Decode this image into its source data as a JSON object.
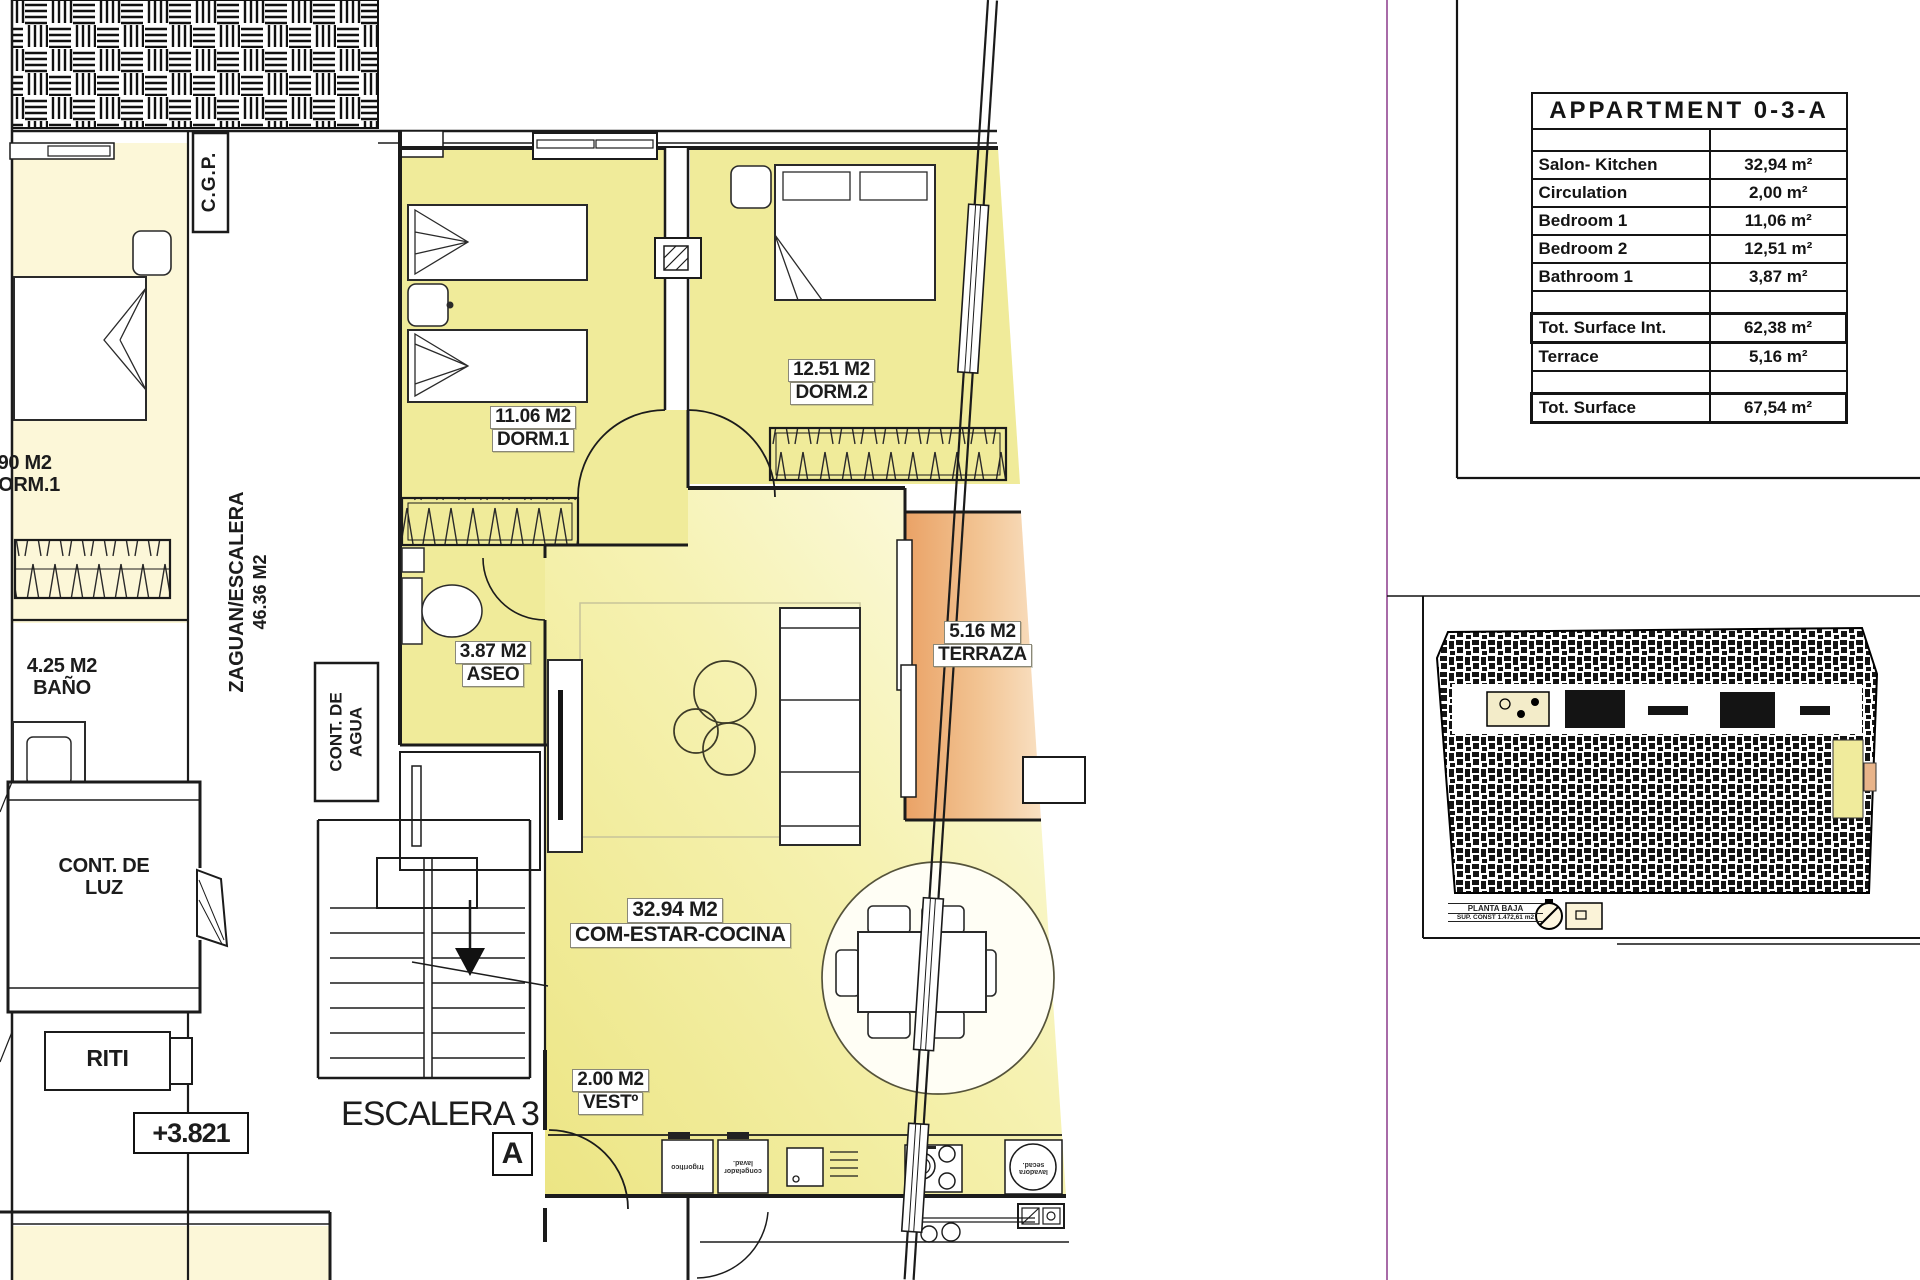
{
  "sheet": {
    "table": {
      "title": "APPARTMENT 0-3-A",
      "rows": [
        {
          "label": "Salon- Kitchen",
          "value": "32,94 m²"
        },
        {
          "label": "Circulation",
          "value": "2,00 m²"
        },
        {
          "label": "Bedroom 1",
          "value": "11,06 m²"
        },
        {
          "label": "Bedroom 2",
          "value": "12,51 m²"
        },
        {
          "label": "Bathroom 1",
          "value": "3,87 m²"
        }
      ],
      "subtotal": {
        "label": "Tot. Surface Int.",
        "value": "62,38 m²"
      },
      "terrace": {
        "label": "Terrace",
        "value": "5,16 m²"
      },
      "total": {
        "label": "Tot. Surface",
        "value": "67,54 m²"
      }
    },
    "mini_plan": {
      "caption_line1": "PLANTA BAJA",
      "caption_line2": "SUP. CONST 1.472,61 m2"
    }
  },
  "plan": {
    "apartment_labels": {
      "dorm1": {
        "area": "11.06 M2",
        "name": "DORM.1"
      },
      "dorm2": {
        "area": "12.51 M2",
        "name": "DORM.2"
      },
      "aseo": {
        "area": "3.87 M2",
        "name": "ASEO"
      },
      "terraza": {
        "area": "5.16 M2",
        "name": "TERRAZA"
      },
      "salon": {
        "area": "32.94 M2",
        "name": "COM-ESTAR-COCINA"
      },
      "vestibulo": {
        "area": "2.00 M2",
        "name": "VESTº"
      }
    },
    "common_labels": {
      "cgp": "C.G.P.",
      "zaguan_name": "ZAGUAN/ESCALERA",
      "zaguan_area": "46.36 M2",
      "cont_agua_1": "CONT. DE",
      "cont_agua_2": "AGUA",
      "cont_luz_1": "CONT. DE",
      "cont_luz_2": "LUZ",
      "riti": "RITI",
      "level": "+3.821",
      "escalera": "ESCALERA 3",
      "section_mark": "A"
    },
    "neighbor_labels": {
      "dorm1_area": ".90 M2",
      "dorm1_name": "DORM.1",
      "bano_area": "4.25 M2",
      "bano_name": "BAÑO"
    },
    "appliance_labels": {
      "a1": "frigorífico",
      "a2": "congelador lavad.",
      "a3": "lavadora secad."
    },
    "colors": {
      "room_yellow": "#f0eb9a",
      "terrace_orange": "#eaa266",
      "boundary_magenta": "#a86ba8"
    }
  }
}
